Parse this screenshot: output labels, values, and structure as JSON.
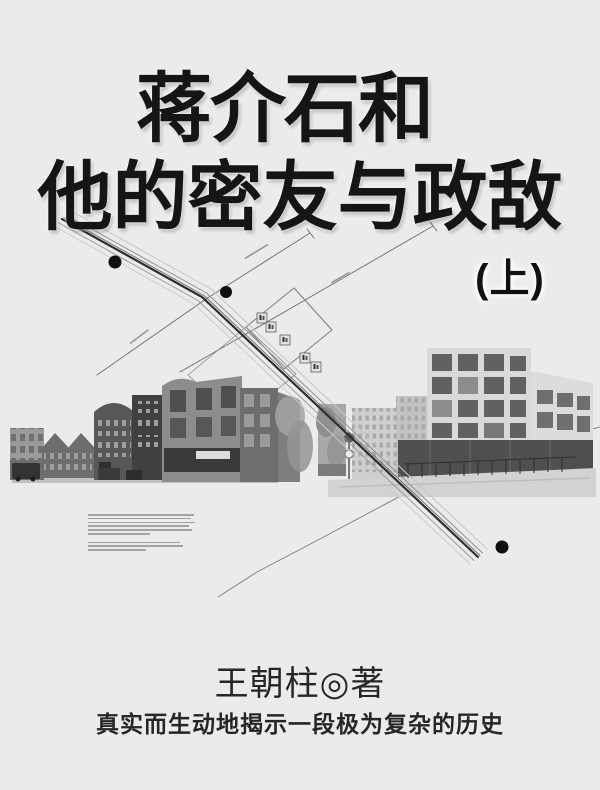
{
  "cover": {
    "title_line1": "蒋介石和",
    "title_line2": "他的密友与政敌",
    "volume_label": "(上)",
    "author": "王朝柱◎著",
    "tagline": "真实而生动地揭示一段极为复杂的历史"
  },
  "colors": {
    "background": "#ebebeb",
    "title_ink": "#151515",
    "body_ink": "#262626",
    "map_road": "#2e2e2e",
    "map_thin_line": "#6a6a6a"
  },
  "artwork": {
    "map_dot_count": 3,
    "signage_badge_count": 5
  }
}
